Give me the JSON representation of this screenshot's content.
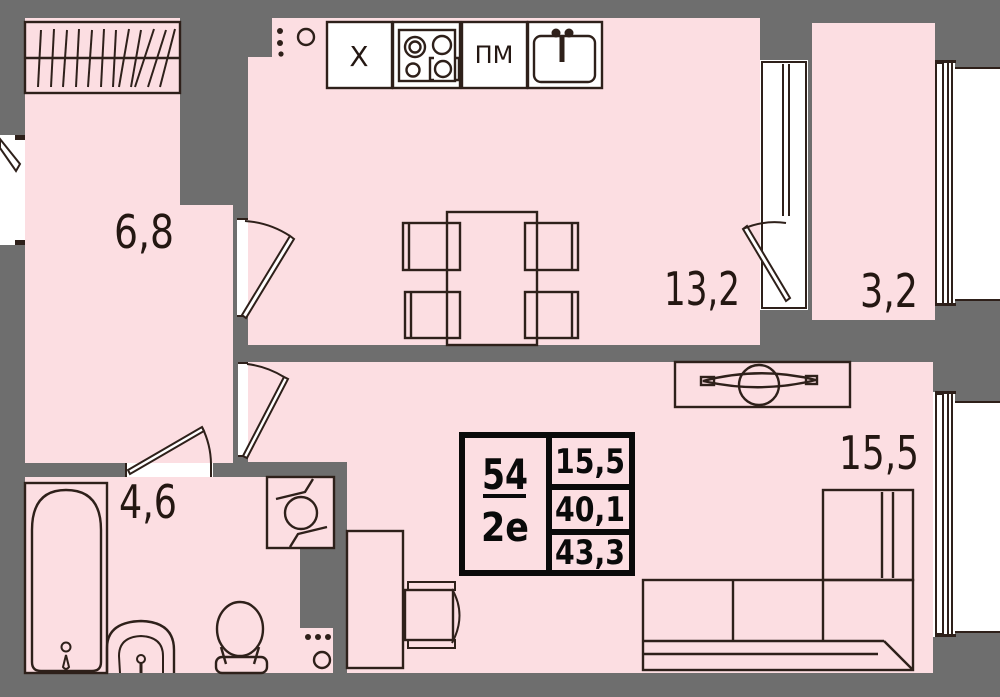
{
  "colors": {
    "background": "#6e6e6e",
    "room_fill": "#fcdee2",
    "line": "#2e201a",
    "opening_white": "#ffffff",
    "info_border": "#0a0a0a"
  },
  "rooms": {
    "hallway": {
      "label": "6,8"
    },
    "kitchen": {
      "label": "13,2"
    },
    "balcony": {
      "label": "3,2"
    },
    "bathroom": {
      "label": "4,6"
    },
    "living_room": {
      "label": "15,5"
    }
  },
  "kitchen_units": {
    "fridge_label": "Х",
    "dishwasher_label": "ПМ"
  },
  "info_box": {
    "flat_number": "54",
    "flat_type": "2е",
    "rows": [
      "15,5",
      "40,1",
      "43,3"
    ]
  }
}
